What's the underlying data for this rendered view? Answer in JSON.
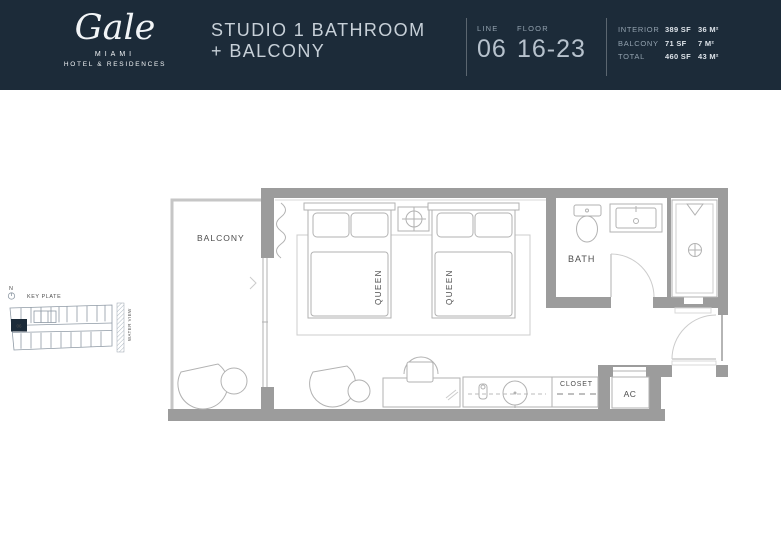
{
  "colors": {
    "header-bg": "#1c2b39",
    "header-text": "#c7d0d8",
    "header-dim": "#93a2af",
    "wall": "#9c9c9c",
    "line": "#b2b2b2",
    "label": "#4d4d4d"
  },
  "header": {
    "brand": {
      "name": "Gale",
      "city": "MIAMI",
      "subtitle": "HOTEL & RESIDENCES"
    },
    "title_line1": "STUDIO 1 BATHROOM",
    "title_line2": "+ BALCONY",
    "line": {
      "label": "LINE",
      "value": "06"
    },
    "floor": {
      "label": "FLOOR",
      "value": "16-23"
    },
    "stats": [
      {
        "label": "INTERIOR",
        "sf": "389 SF",
        "m2": "36 M²"
      },
      {
        "label": "BALCONY",
        "sf": "71 SF",
        "m2": "7 M²"
      },
      {
        "label": "TOTAL",
        "sf": "460 SF",
        "m2": "43 M²"
      }
    ]
  },
  "keyplate": {
    "north_label": "N",
    "title": "KEY PLATE",
    "unit_number": "06",
    "water_label": "WATER VIEW"
  },
  "plan": {
    "labels": {
      "balcony": "BALCONY",
      "bed1": "QUEEN",
      "bed2": "QUEEN",
      "bath": "BATH",
      "closet": "CLOSET",
      "ac": "AC"
    }
  }
}
